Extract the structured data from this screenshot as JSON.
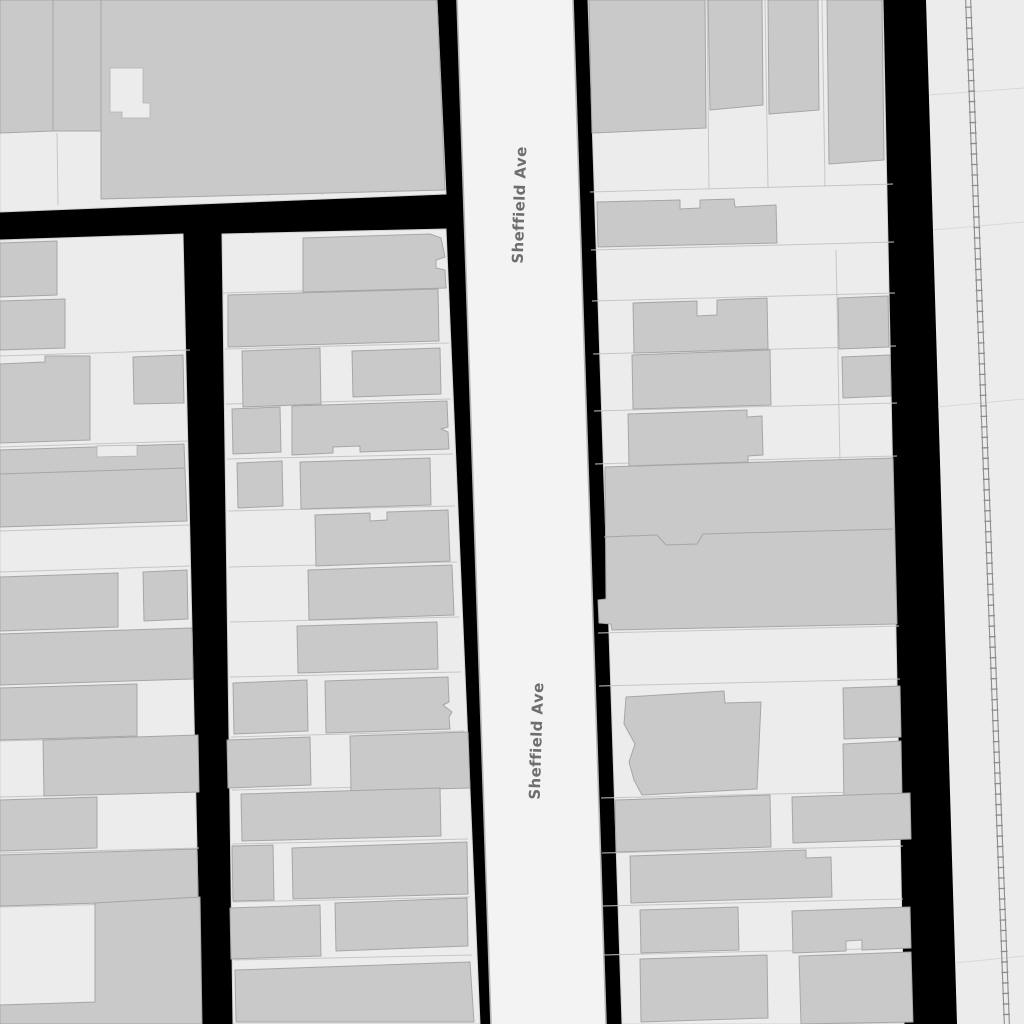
{
  "map": {
    "background_color": "#000000",
    "road_name": "Sheffield Ave",
    "street_labels": [
      {
        "text": "Sheffield Ave",
        "x": 520,
        "y": 205,
        "rotation": -88.2
      },
      {
        "text": "Sheffield Ave",
        "x": 537,
        "y": 741,
        "rotation": -88.2
      }
    ],
    "colors": {
      "block": "#ececec",
      "road": "#f3f3f3",
      "road_casing": "#b5b5b5",
      "building": "#c9c9c9",
      "building_stroke": "#a6a6a6",
      "parcel_line": "#c6c6c6",
      "railway": "#8d8d8d",
      "label_text": "#6e6e6e"
    },
    "blocks": [
      {
        "points": "0,0 437,0 446,194 0,212"
      },
      {
        "points": "0,240 183,234 201,1024 0,1024"
      },
      {
        "points": "222,234 446,229 480,1024 233,1024"
      },
      {
        "points": "588,0 883,0 904,1024 622,1024"
      },
      {
        "points": "926,0 1024,0 1024,1024 957,1024",
        "kind": "corridor"
      }
    ],
    "roads": [
      {
        "points": "457,0 573,0 606,1024 491,1024"
      }
    ],
    "road_casings": [
      {
        "x1": 457,
        "y1": 0,
        "x2": 491,
        "y2": 1024
      },
      {
        "x1": 573,
        "y1": 0,
        "x2": 606,
        "y2": 1024
      }
    ],
    "buildings": [
      {
        "points": "0,0 53,0 53,131 0,133"
      },
      {
        "points": "53,0 101,0 101,131 53,131"
      },
      {
        "points": "101,0 437,0 445,190 101,199"
      },
      {
        "points": "0,243 57,241 57,295 0,297"
      },
      {
        "points": "0,301 65,299 65,348 0,350"
      },
      {
        "points": "0,364 45,362 45,356 90,356 90,440 0,443"
      },
      {
        "points": "133,357 183,355 184,403 134,404"
      },
      {
        "points": "0,450 184,444 187,521 0,527"
      },
      {
        "points": "0,577 118,573 118,627 0,631"
      },
      {
        "points": "143,572 187,570 188,619 144,621"
      },
      {
        "points": "0,634 192,628 193,679 0,685"
      },
      {
        "points": "0,688 137,684 137,736 0,740"
      },
      {
        "points": "43,740 198,735 199,792 44,796"
      },
      {
        "points": "0,800 97,797 97,848 0,851"
      },
      {
        "points": "0,855 197,849 198,900 0,906"
      },
      {
        "points": "95,903 200,897 202,1024 0,1024 0,1005 95,1002"
      },
      {
        "points": "303,238 430,234 441,238 445,257 436,260 436,268 445,270 446,288 303,292"
      },
      {
        "points": "228,295 438,289 439,341 228,347"
      },
      {
        "points": "242,351 320,348 321,404 243,407"
      },
      {
        "points": "352,351 440,348 441,394 353,397"
      },
      {
        "points": "232,409 280,407 281,452 233,454"
      },
      {
        "points": "292,406 447,401 448,427 441,429 448,432 449,449 360,452 360,446 333,447 333,453 292,455"
      },
      {
        "points": "237,463 282,461 283,506 238,508"
      },
      {
        "points": "300,462 430,458 431,505 301,509"
      },
      {
        "points": "315,515 370,513 370,521 387,520 387,512 448,510 450,561 316,566"
      },
      {
        "points": "308,570 452,565 454,615 309,620"
      },
      {
        "points": "297,626 437,622 438,669 298,673"
      },
      {
        "points": "233,683 307,680 308,731 234,734"
      },
      {
        "points": "325,681 448,677 449,702 443,705 452,712 449,717 450,729 326,733"
      },
      {
        "points": "227,740 310,737 311,785 228,788"
      },
      {
        "points": "350,736 468,732 470,788 351,791"
      },
      {
        "points": "241,794 440,788 441,836 242,841"
      },
      {
        "points": "232,846 273,845 274,900 233,901"
      },
      {
        "points": "292,848 467,842 468,894 293,899"
      },
      {
        "points": "230,908 320,905 321,956 231,959"
      },
      {
        "points": "335,903 467,898 468,946 336,951"
      },
      {
        "points": "235,970 470,962 474,1022 236,1022"
      },
      {
        "points": "589,0 705,0 706,128 592,133"
      },
      {
        "points": "708,0 762,0 763,105 710,110"
      },
      {
        "points": "768,0 818,0 819,110 769,114"
      },
      {
        "points": "827,0 882,0 884,160 829,164"
      },
      {
        "points": "597,202 680,200 680,209 700,208 700,200 734,199 735,207 776,205 777,243 598,247"
      },
      {
        "points": "633,303 697,301 697,316 717,315 717,300 767,298 768,349 634,353"
      },
      {
        "points": "838,298 888,296 889,347 839,349"
      },
      {
        "points": "632,355 770,350 771,405 633,409"
      },
      {
        "points": "842,357 890,355 891,396 843,398"
      },
      {
        "points": "628,414 747,410 747,417 762,416 763,455 748,456 748,462 629,466"
      },
      {
        "points": "605,467 893,458 897,624 612,630 611,624 599,623 598,600 606,599"
      },
      {
        "points": "626,697 724,691 725,703 761,702 757,789 642,795 634,780 629,762 635,744 624,724"
      },
      {
        "points": "843,688 900,686 901,737 844,739"
      },
      {
        "points": "843,744 901,741 902,796 844,799"
      },
      {
        "points": "615,800 770,795 771,847 616,852"
      },
      {
        "points": "792,797 910,793 911,839 793,843"
      },
      {
        "points": "630,856 806,850 806,858 831,857 832,897 631,903"
      },
      {
        "points": "640,910 738,907 739,950 641,953"
      },
      {
        "points": "792,911 910,907 911,948 862,950 862,940 846,941 846,951 793,953"
      },
      {
        "points": "640,959 767,955 768,1018 641,1022"
      },
      {
        "points": "799,956 911,952 913,1022 801,1024"
      }
    ],
    "courtyards": [
      {
        "points": "110,68 143,68 143,103 150,103 150,118 122,118 122,112 110,112"
      },
      {
        "points": "97,446 137,445 137,456 97,457"
      }
    ],
    "building_seams": [
      {
        "d": "M604,537 L657,535 L666,545 L697,544 L703,534 L893,529"
      },
      {
        "d": "M0,474 L185,468"
      }
    ],
    "parcel_lines": [
      {
        "x1": 157,
        "y1": 0,
        "x2": 162,
        "y2": 197
      },
      {
        "x1": 217,
        "y1": 0,
        "x2": 222,
        "y2": 196
      },
      {
        "x1": 263,
        "y1": 0,
        "x2": 268,
        "y2": 196
      },
      {
        "x1": 317,
        "y1": 0,
        "x2": 322,
        "y2": 195
      },
      {
        "x1": 380,
        "y1": 0,
        "x2": 385,
        "y2": 193
      },
      {
        "x1": 57,
        "y1": 133,
        "x2": 58,
        "y2": 205
      },
      {
        "x1": 0,
        "y1": 356,
        "x2": 190,
        "y2": 350
      },
      {
        "x1": 0,
        "y1": 447,
        "x2": 188,
        "y2": 441
      },
      {
        "x1": 0,
        "y1": 531,
        "x2": 190,
        "y2": 525
      },
      {
        "x1": 0,
        "y1": 572,
        "x2": 190,
        "y2": 566
      },
      {
        "x1": 0,
        "y1": 741,
        "x2": 196,
        "y2": 736
      },
      {
        "x1": 0,
        "y1": 797,
        "x2": 198,
        "y2": 792
      },
      {
        "x1": 0,
        "y1": 853,
        "x2": 199,
        "y2": 848
      },
      {
        "x1": 0,
        "y1": 907,
        "x2": 200,
        "y2": 902
      },
      {
        "x1": 223,
        "y1": 293,
        "x2": 447,
        "y2": 287
      },
      {
        "x1": 225,
        "y1": 349,
        "x2": 449,
        "y2": 343
      },
      {
        "x1": 226,
        "y1": 404,
        "x2": 451,
        "y2": 399
      },
      {
        "x1": 227,
        "y1": 459,
        "x2": 453,
        "y2": 454
      },
      {
        "x1": 228,
        "y1": 511,
        "x2": 455,
        "y2": 506
      },
      {
        "x1": 229,
        "y1": 567,
        "x2": 457,
        "y2": 562
      },
      {
        "x1": 230,
        "y1": 622,
        "x2": 459,
        "y2": 617
      },
      {
        "x1": 230,
        "y1": 677,
        "x2": 461,
        "y2": 672
      },
      {
        "x1": 231,
        "y1": 737,
        "x2": 464,
        "y2": 731
      },
      {
        "x1": 232,
        "y1": 790,
        "x2": 466,
        "y2": 785
      },
      {
        "x1": 232,
        "y1": 844,
        "x2": 468,
        "y2": 839
      },
      {
        "x1": 233,
        "y1": 902,
        "x2": 470,
        "y2": 897
      },
      {
        "x1": 234,
        "y1": 960,
        "x2": 472,
        "y2": 955
      },
      {
        "x1": 590,
        "y1": 192,
        "x2": 893,
        "y2": 184
      },
      {
        "x1": 591,
        "y1": 250,
        "x2": 894,
        "y2": 242
      },
      {
        "x1": 592,
        "y1": 301,
        "x2": 895,
        "y2": 293
      },
      {
        "x1": 593,
        "y1": 354,
        "x2": 896,
        "y2": 346
      },
      {
        "x1": 594,
        "y1": 411,
        "x2": 897,
        "y2": 403
      },
      {
        "x1": 595,
        "y1": 464,
        "x2": 897,
        "y2": 456
      },
      {
        "x1": 598,
        "y1": 633,
        "x2": 899,
        "y2": 626
      },
      {
        "x1": 599,
        "y1": 686,
        "x2": 900,
        "y2": 679
      },
      {
        "x1": 601,
        "y1": 798,
        "x2": 902,
        "y2": 791
      },
      {
        "x1": 602,
        "y1": 853,
        "x2": 903,
        "y2": 846
      },
      {
        "x1": 603,
        "y1": 906,
        "x2": 903,
        "y2": 899
      },
      {
        "x1": 604,
        "y1": 955,
        "x2": 904,
        "y2": 948
      },
      {
        "x1": 707,
        "y1": 0,
        "x2": 709,
        "y2": 189
      },
      {
        "x1": 765,
        "y1": 0,
        "x2": 768,
        "y2": 188
      },
      {
        "x1": 822,
        "y1": 0,
        "x2": 825,
        "y2": 187
      },
      {
        "x1": 836,
        "y1": 250,
        "x2": 840,
        "y2": 463
      }
    ],
    "corridor_seams": [
      {
        "x1": 929,
        "y1": 95,
        "x2": 1024,
        "y2": 88
      },
      {
        "x1": 933,
        "y1": 230,
        "x2": 1024,
        "y2": 222
      },
      {
        "x1": 938,
        "y1": 407,
        "x2": 1024,
        "y2": 399
      },
      {
        "x1": 955,
        "y1": 963,
        "x2": 1024,
        "y2": 956
      }
    ],
    "railway": {
      "ties": {
        "x1": 968,
        "y1": -4,
        "x2": 1007,
        "y2": 1028
      },
      "rails": [
        {
          "x1": 965.5,
          "y1": -4,
          "x2": 1004.5,
          "y2": 1028
        },
        {
          "x1": 970.5,
          "y1": -4,
          "x2": 1009.5,
          "y2": 1028
        }
      ]
    }
  }
}
